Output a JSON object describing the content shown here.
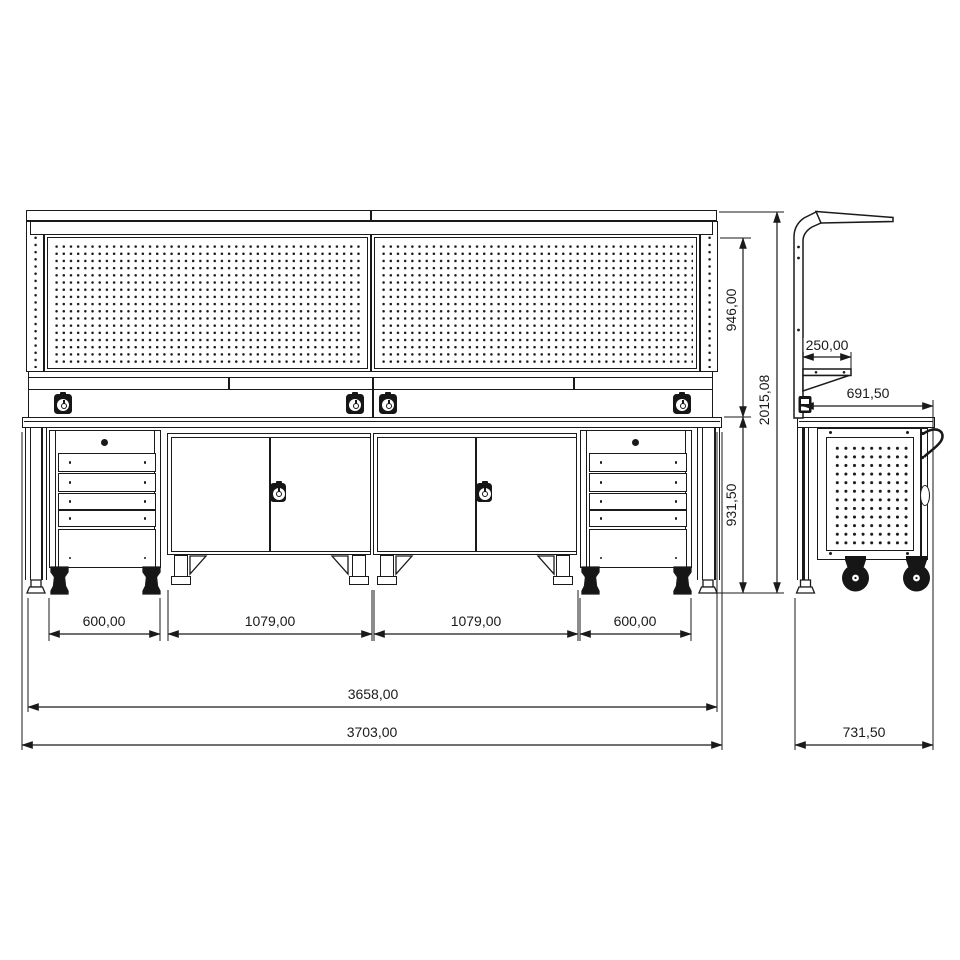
{
  "colors": {
    "line": "#1a1a1a",
    "background": "#ffffff",
    "fill_dark": "#161616"
  },
  "dims": {
    "module_left": "600,00",
    "cabinet_left": "1079,00",
    "cabinet_right": "1079,00",
    "module_right": "600,00",
    "inner_width": "3658,00",
    "total_width": "3703,00",
    "panel_height": "946,00",
    "bench_height": "931,50",
    "total_height": "2015,08",
    "shelf_depth": "250,00",
    "bench_depth": "691,50",
    "total_depth": "731,50"
  }
}
